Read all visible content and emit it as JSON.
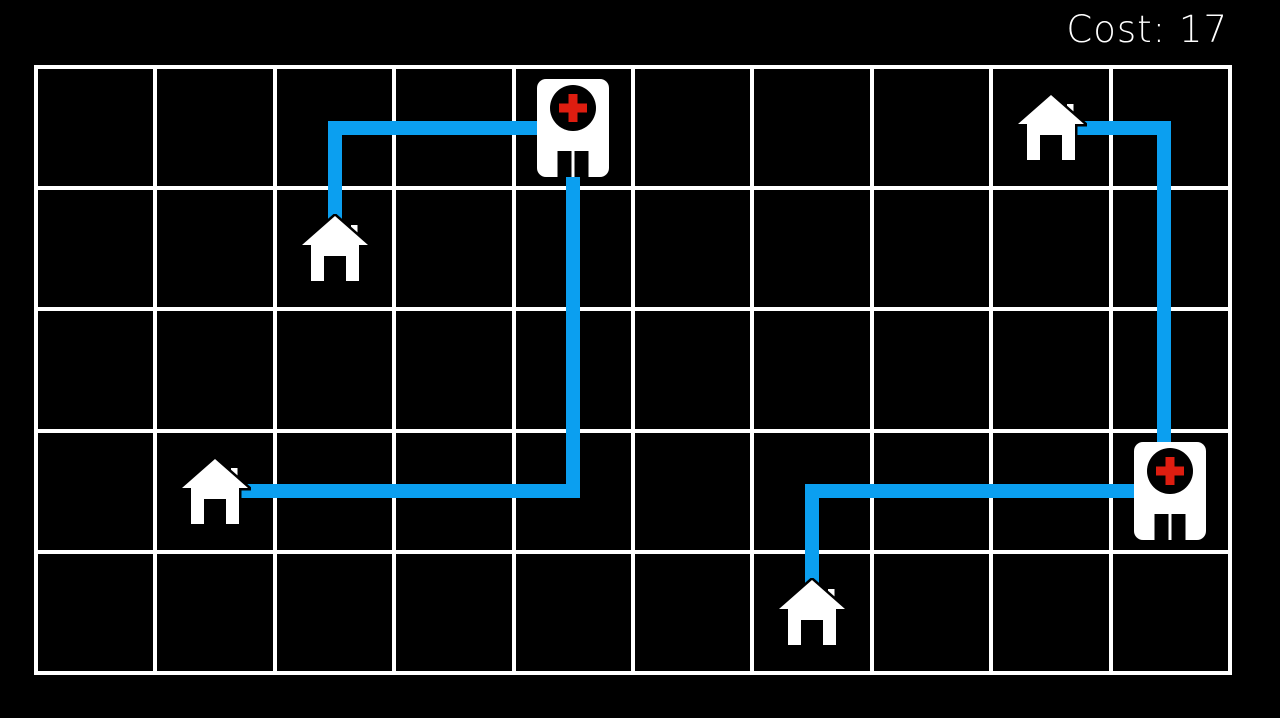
{
  "hud": {
    "cost_label": "Cost: 17"
  },
  "colors": {
    "background": "#000000",
    "grid_line": "#ffffff",
    "path": "#0b9ff0",
    "icon": "#ffffff",
    "hospital_circle": "#000000",
    "cross_red": "#de1d10",
    "text": "#ffffff"
  },
  "board": {
    "x": 36,
    "y": 67,
    "cols": 10,
    "rows": 5,
    "cell_w": 119.4,
    "cell_h": 121.2,
    "line_w": 4
  },
  "houses": [
    {
      "id": "house-1",
      "col": 3,
      "row": 2
    },
    {
      "id": "house-2",
      "col": 2,
      "row": 4
    },
    {
      "id": "house-3",
      "col": 9,
      "row": 1
    },
    {
      "id": "house-4",
      "col": 7,
      "row": 5
    }
  ],
  "hospitals": [
    {
      "id": "hospital-1",
      "col": 5,
      "row": 1
    },
    {
      "id": "hospital-2",
      "col": 10,
      "row": 4
    }
  ],
  "routes": [
    {
      "from": "house-1",
      "to": "hospital-1",
      "segments": [
        {
          "x": 327.5,
          "y": 120.6,
          "w": 14,
          "h": 102
        },
        {
          "x": 327.5,
          "y": 120.6,
          "w": 212,
          "h": 14
        }
      ]
    },
    {
      "from": "house-2",
      "to": "hospital-1",
      "segments": [
        {
          "x": 566.3,
          "y": 170,
          "w": 14,
          "h": 328
        },
        {
          "x": 241,
          "y": 484.2,
          "w": 339.3,
          "h": 14
        }
      ]
    },
    {
      "from": "house-3",
      "to": "hospital-2",
      "segments": [
        {
          "x": 1077,
          "y": 120.6,
          "w": 93.5,
          "h": 14
        },
        {
          "x": 1156.5,
          "y": 120.6,
          "w": 14,
          "h": 325
        }
      ]
    },
    {
      "from": "house-4",
      "to": "hospital-2",
      "segments": [
        {
          "x": 805.1,
          "y": 484.2,
          "w": 14,
          "h": 102
        },
        {
          "x": 805.1,
          "y": 484.2,
          "w": 331.2,
          "h": 14
        }
      ]
    }
  ]
}
